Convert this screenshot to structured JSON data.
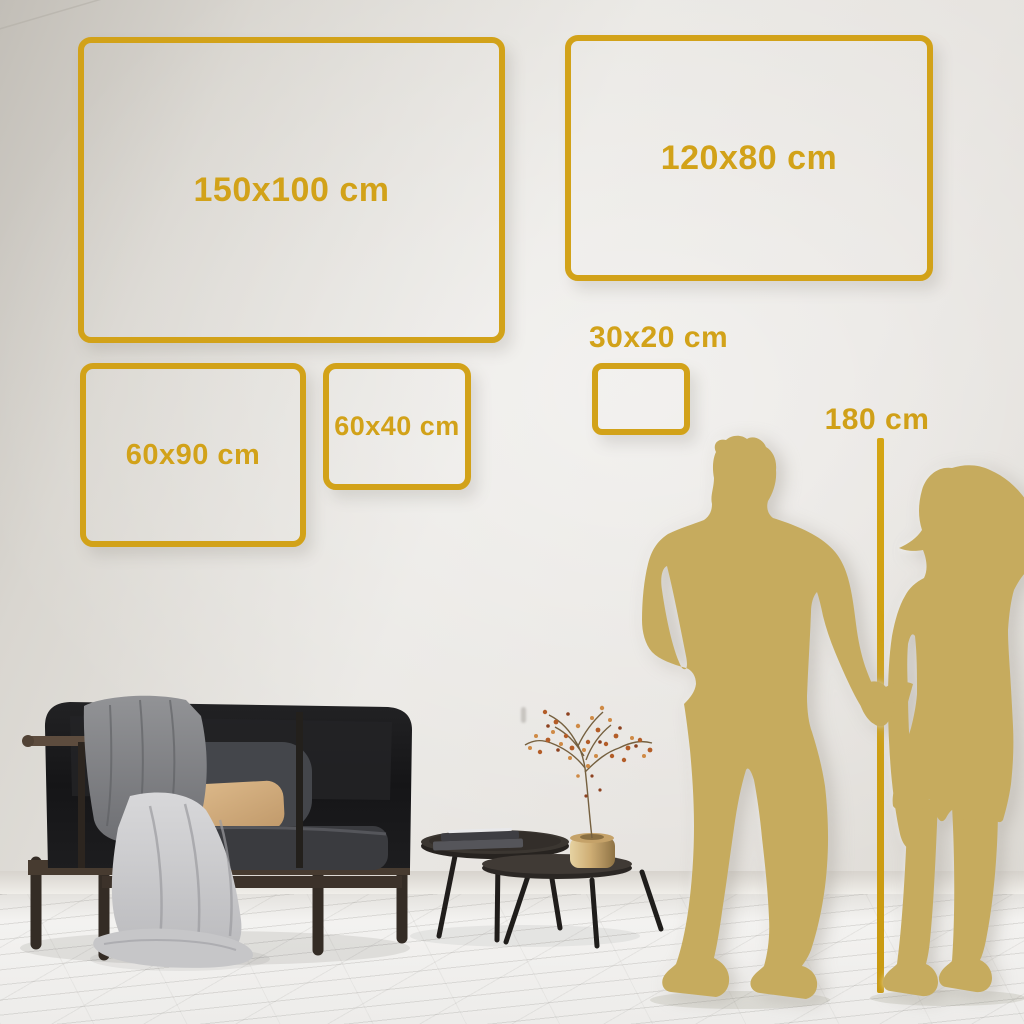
{
  "frames": [
    {
      "id": "150x100",
      "label": "150x100 cm"
    },
    {
      "id": "120x80",
      "label": "120x80 cm"
    },
    {
      "id": "60x90",
      "label": "60x90 cm"
    },
    {
      "id": "60x40",
      "label": "60x40 cm"
    },
    {
      "id": "30x20",
      "label": "30x20 cm"
    }
  ],
  "height_marker": {
    "label": "180 cm"
  },
  "colors": {
    "accent_gold": "#D2A219",
    "silhouette_gold": "#C6AB5E",
    "wall": "#E4E1DC",
    "floor": "#F2F1EF"
  }
}
